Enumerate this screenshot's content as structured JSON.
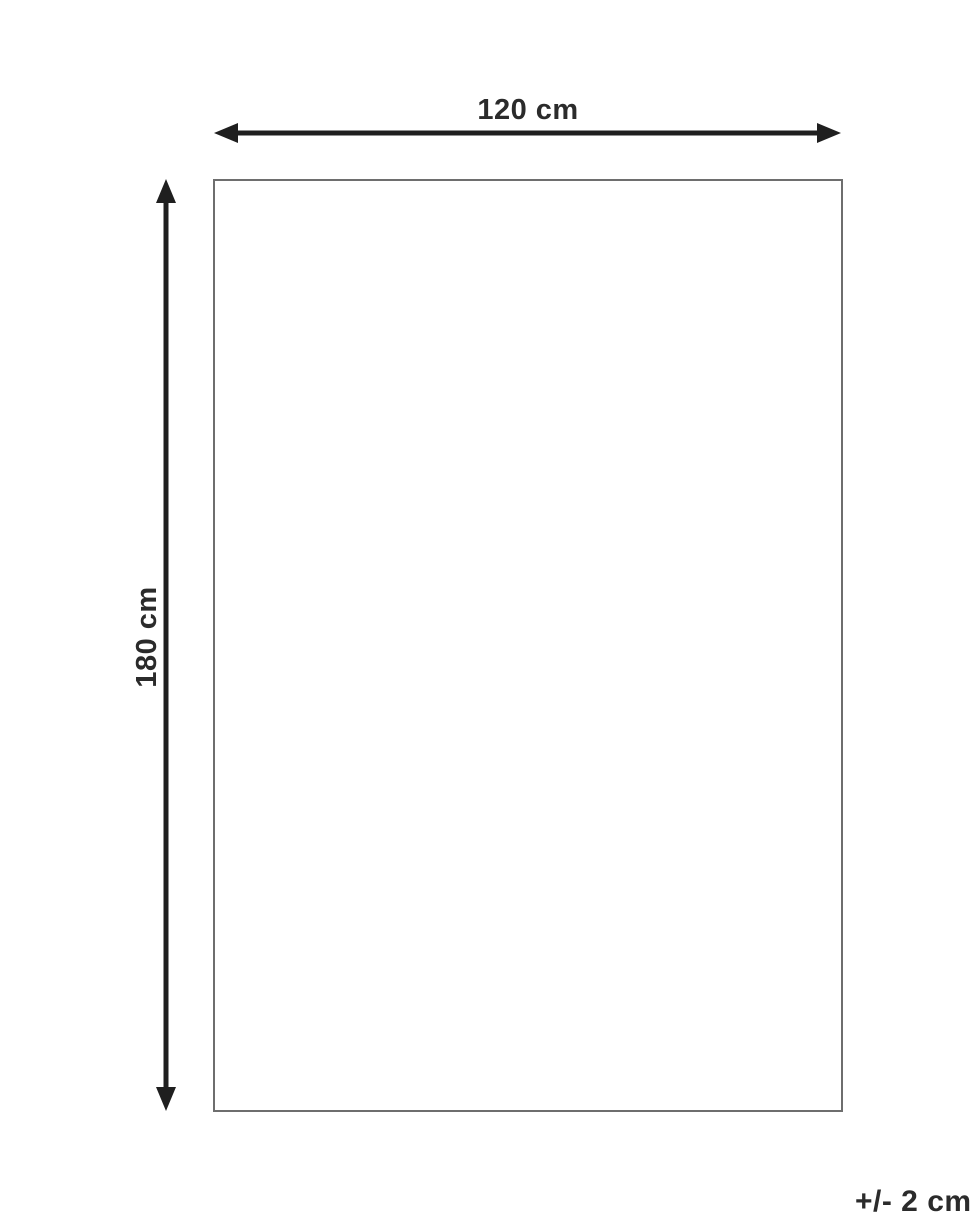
{
  "diagram": {
    "title": "product-dimension-diagram",
    "width_label": "120 cm",
    "height_label": "180 cm",
    "tolerance_label": "+/- 2 cm",
    "colors": {
      "arrow": "#1f1f1f",
      "outline": "#6e6e6e",
      "text": "#2b2b2b",
      "background": "#ffffff"
    }
  }
}
